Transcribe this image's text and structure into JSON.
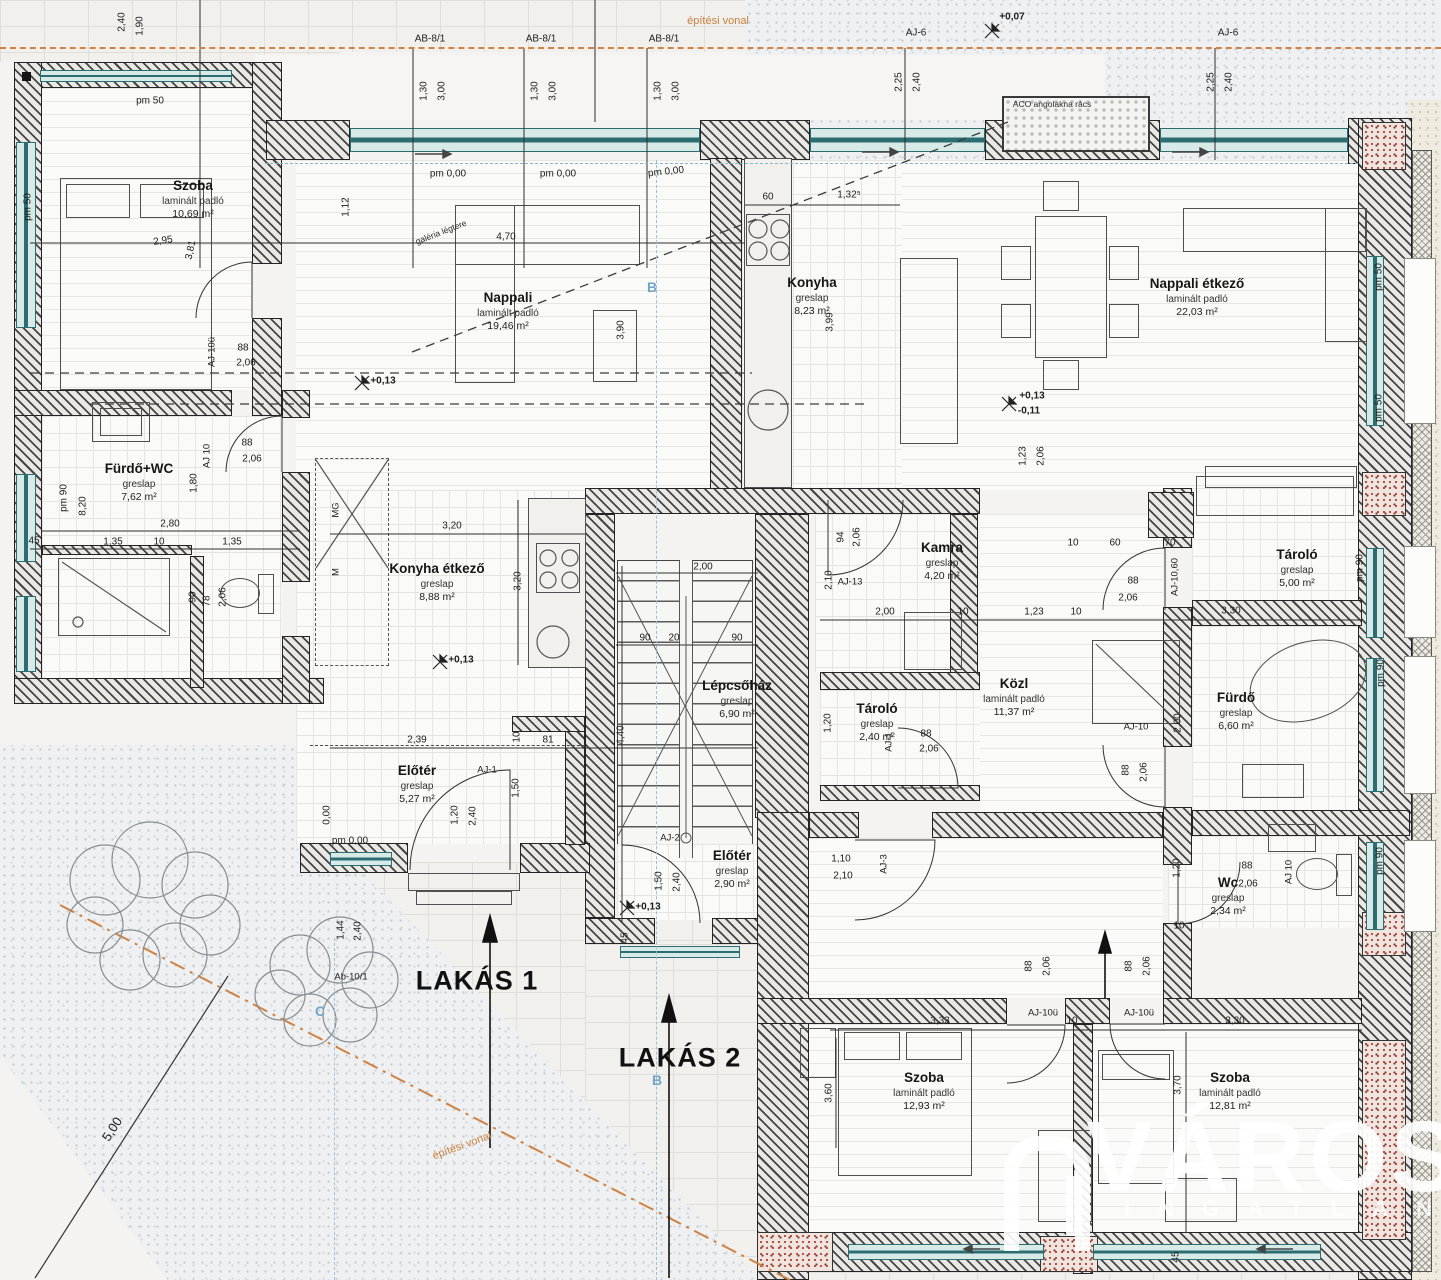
{
  "title": "társasházi alaprajz",
  "apartments": [
    {
      "label": "LAKÁS 1",
      "x": 477,
      "y": 981
    },
    {
      "label": "LAKÁS 2",
      "x": 680,
      "y": 1058
    }
  ],
  "watermark": {
    "title": "VÁROSI",
    "subtitle": "INGATLAN"
  },
  "colors": {
    "build_line": "#cf8243",
    "window": "#2c6d72",
    "section": "#70a5c9",
    "wall": "#242424"
  },
  "rooms": [
    {
      "name": "Szoba",
      "mat": "laminált padló",
      "area": "10,69 m²",
      "x": 193,
      "y": 187
    },
    {
      "name": "Nappali",
      "mat": "laminált padló",
      "area": "19,46 m²",
      "x": 508,
      "y": 299
    },
    {
      "name": "Konyha",
      "mat": "greslap",
      "area": "8,23 m²",
      "x": 812,
      "y": 284
    },
    {
      "name": "Nappali étkező",
      "mat": "laminált padló",
      "area": "22,03 m²",
      "x": 1197,
      "y": 285
    },
    {
      "name": "Fürdő+WC",
      "mat": "greslap",
      "area": "7,62 m²",
      "x": 139,
      "y": 470
    },
    {
      "name": "Konyha étkező",
      "mat": "greslap",
      "area": "8,88 m²",
      "x": 437,
      "y": 570
    },
    {
      "name": "Lépcsőház",
      "mat": "greslap",
      "area": "6,90 m²",
      "x": 737,
      "y": 687
    },
    {
      "name": "Előtér",
      "mat": "greslap",
      "area": "5,27 m²",
      "x": 417,
      "y": 772
    },
    {
      "name": "Előtér",
      "mat": "greslap",
      "area": "2,90 m²",
      "x": 732,
      "y": 857
    },
    {
      "name": "Kamra",
      "mat": "greslap",
      "area": "4,20 m²",
      "x": 942,
      "y": 549
    },
    {
      "name": "Tároló",
      "mat": "greslap",
      "area": "2,40 m²",
      "x": 877,
      "y": 710
    },
    {
      "name": "Közl",
      "mat": "laminált padló",
      "area": "11,37 m²",
      "x": 1014,
      "y": 685
    },
    {
      "name": "Fürdő",
      "mat": "greslap",
      "area": "6,60 m²",
      "x": 1236,
      "y": 699
    },
    {
      "name": "Tároló",
      "mat": "greslap",
      "area": "5,00 m²",
      "x": 1297,
      "y": 556
    },
    {
      "name": "Wc",
      "mat": "greslap",
      "area": "2,34 m²",
      "x": 1228,
      "y": 884
    },
    {
      "name": "Szoba",
      "mat": "laminált padló",
      "area": "12,93 m²",
      "x": 924,
      "y": 1079
    },
    {
      "name": "Szoba",
      "mat": "laminált padló",
      "area": "12,81 m²",
      "x": 1230,
      "y": 1079
    }
  ],
  "labels": [
    {
      "t": "2,40",
      "x": 122,
      "y": 22,
      "r": -90
    },
    {
      "t": "1,90",
      "x": 140,
      "y": 26,
      "r": -90
    },
    {
      "t": "AB-8/1",
      "x": 430,
      "y": 39
    },
    {
      "t": "AB-8/1",
      "x": 541,
      "y": 39
    },
    {
      "t": "AB-8/1",
      "x": 664,
      "y": 39
    },
    {
      "t": "1,30",
      "x": 424,
      "y": 91,
      "r": -90
    },
    {
      "t": "3,00",
      "x": 442,
      "y": 91,
      "r": -90
    },
    {
      "t": "1,30",
      "x": 535,
      "y": 91,
      "r": -90
    },
    {
      "t": "3,00",
      "x": 553,
      "y": 91,
      "r": -90
    },
    {
      "t": "1,30",
      "x": 658,
      "y": 91,
      "r": -90
    },
    {
      "t": "3,00",
      "x": 676,
      "y": 91,
      "r": -90
    },
    {
      "t": "pm 0,00",
      "x": 448,
      "y": 174
    },
    {
      "t": "pm 0,00",
      "x": 558,
      "y": 174
    },
    {
      "t": "pm 0,00",
      "x": 666,
      "y": 172,
      "r": -6
    },
    {
      "t": "építési vonal",
      "x": 718,
      "y": 21,
      "c": "note"
    },
    {
      "t": "AJ-6",
      "x": 916,
      "y": 33
    },
    {
      "t": "2,25",
      "x": 899,
      "y": 82,
      "r": -90
    },
    {
      "t": "2,40",
      "x": 917,
      "y": 82,
      "r": -90
    },
    {
      "t": "AJ-6",
      "x": 1228,
      "y": 33
    },
    {
      "t": "2,25",
      "x": 1211,
      "y": 82,
      "r": -90
    },
    {
      "t": "2,40",
      "x": 1229,
      "y": 82,
      "r": -90
    },
    {
      "t": "+0,07",
      "x": 1012,
      "y": 17,
      "c": "level"
    },
    {
      "t": "ACO angolakna rács",
      "x": 1052,
      "y": 104,
      "c": "tiny"
    },
    {
      "t": "pm 50",
      "x": 150,
      "y": 101
    },
    {
      "t": "pm 50",
      "x": 28,
      "y": 207,
      "r": -90
    },
    {
      "t": "2,95",
      "x": 163,
      "y": 241,
      "r": -8
    },
    {
      "t": "3,81",
      "x": 191,
      "y": 250,
      "r": -78
    },
    {
      "t": "1,12",
      "x": 346,
      "y": 207,
      "r": -90
    },
    {
      "t": "AJ-10ü",
      "x": 212,
      "y": 352,
      "r": -90,
      "c": "code"
    },
    {
      "t": "88",
      "x": 243,
      "y": 348
    },
    {
      "t": "2,06",
      "x": 246,
      "y": 363
    },
    {
      "t": "4,70",
      "x": 506,
      "y": 237
    },
    {
      "t": "3,90",
      "x": 621,
      "y": 330,
      "r": -90
    },
    {
      "t": "+0,13",
      "x": 383,
      "y": 381,
      "c": "level"
    },
    {
      "t": "galéria légtere",
      "x": 441,
      "y": 232,
      "r": -21,
      "c": "tiny"
    },
    {
      "t": "60",
      "x": 768,
      "y": 197
    },
    {
      "t": "1,32⁵",
      "x": 849,
      "y": 195
    },
    {
      "t": "3,99",
      "x": 830,
      "y": 322,
      "r": -90
    },
    {
      "t": "+0,13",
      "x": 1032,
      "y": 396,
      "c": "level"
    },
    {
      "t": "-0,11",
      "x": 1029,
      "y": 411,
      "c": "level"
    },
    {
      "t": "1,23",
      "x": 1023,
      "y": 456,
      "r": -90
    },
    {
      "t": "2,06",
      "x": 1041,
      "y": 456,
      "r": -90
    },
    {
      "t": "pm 50",
      "x": 1379,
      "y": 277,
      "r": -90
    },
    {
      "t": "pm 50",
      "x": 1379,
      "y": 408,
      "r": -90
    },
    {
      "t": "2,80",
      "x": 170,
      "y": 524
    },
    {
      "t": "1,35",
      "x": 113,
      "y": 542
    },
    {
      "t": "10",
      "x": 159,
      "y": 542
    },
    {
      "t": "1,35",
      "x": 232,
      "y": 542
    },
    {
      "t": "1,80",
      "x": 194,
      "y": 483,
      "r": -90
    },
    {
      "t": "AJ 10",
      "x": 207,
      "y": 456,
      "r": -90,
      "c": "code"
    },
    {
      "t": "88",
      "x": 247,
      "y": 443
    },
    {
      "t": "2,06",
      "x": 252,
      "y": 459
    },
    {
      "t": "pm 90",
      "x": 64,
      "y": 498,
      "r": -90
    },
    {
      "t": "8,20",
      "x": 83,
      "y": 506,
      "r": -90
    },
    {
      "t": "45",
      "x": 34,
      "y": 541
    },
    {
      "t": "90",
      "x": 193,
      "y": 597,
      "r": -90
    },
    {
      "t": "78",
      "x": 207,
      "y": 601,
      "r": -90
    },
    {
      "t": "2,06",
      "x": 223,
      "y": 597,
      "r": -90
    },
    {
      "t": "MG",
      "x": 336,
      "y": 510,
      "r": -90,
      "c": "code"
    },
    {
      "t": "M",
      "x": 336,
      "y": 572,
      "r": -90,
      "c": "code"
    },
    {
      "t": "3,20",
      "x": 452,
      "y": 526
    },
    {
      "t": "3,20",
      "x": 518,
      "y": 581,
      "r": -90
    },
    {
      "t": "+0,13",
      "x": 461,
      "y": 660,
      "c": "level"
    },
    {
      "t": "2,39",
      "x": 417,
      "y": 740
    },
    {
      "t": "10",
      "x": 517,
      "y": 737,
      "r": -90
    },
    {
      "t": "81",
      "x": 548,
      "y": 740
    },
    {
      "t": "2,00",
      "x": 703,
      "y": 567
    },
    {
      "t": "90",
      "x": 645,
      "y": 638
    },
    {
      "t": "20",
      "x": 674,
      "y": 638
    },
    {
      "t": "90",
      "x": 737,
      "y": 638
    },
    {
      "t": "4,40",
      "x": 621,
      "y": 735,
      "r": -90
    },
    {
      "t": "AJ-2",
      "x": 670,
      "y": 838,
      "c": "code"
    },
    {
      "t": "1,50",
      "x": 659,
      "y": 881,
      "r": -90
    },
    {
      "t": "2,40",
      "x": 677,
      "y": 882,
      "r": -90
    },
    {
      "t": "AJ-1",
      "x": 487,
      "y": 770,
      "c": "code"
    },
    {
      "t": "1,20",
      "x": 455,
      "y": 815,
      "r": -90
    },
    {
      "t": "2,40",
      "x": 473,
      "y": 816,
      "r": -90
    },
    {
      "t": "1,50",
      "x": 516,
      "y": 788,
      "r": -90
    },
    {
      "t": "pm 0,00",
      "x": 350,
      "y": 841
    },
    {
      "t": "0,00",
      "x": 327,
      "y": 815,
      "r": -90
    },
    {
      "t": "1,44",
      "x": 341,
      "y": 930,
      "r": -90
    },
    {
      "t": "2,40",
      "x": 358,
      "y": 931,
      "r": -90
    },
    {
      "t": "Ab-10/1",
      "x": 351,
      "y": 977,
      "c": "code"
    },
    {
      "t": "+0,13",
      "x": 648,
      "y": 907,
      "c": "level"
    },
    {
      "t": "45",
      "x": 625,
      "y": 938,
      "r": -90
    },
    {
      "t": "AJ-3",
      "x": 884,
      "y": 864,
      "r": -90,
      "c": "code"
    },
    {
      "t": "1,10",
      "x": 841,
      "y": 859
    },
    {
      "t": "2,10",
      "x": 843,
      "y": 876
    },
    {
      "t": "AJ-13",
      "x": 850,
      "y": 582,
      "c": "code"
    },
    {
      "t": "2,10",
      "x": 829,
      "y": 580,
      "r": -90
    },
    {
      "t": "94",
      "x": 841,
      "y": 537,
      "r": -90
    },
    {
      "t": "2,06",
      "x": 857,
      "y": 537,
      "r": -90
    },
    {
      "t": "2,00",
      "x": 885,
      "y": 612
    },
    {
      "t": "10",
      "x": 963,
      "y": 612
    },
    {
      "t": "1,23",
      "x": 1034,
      "y": 612
    },
    {
      "t": "10",
      "x": 1076,
      "y": 612
    },
    {
      "t": "10",
      "x": 1073,
      "y": 543
    },
    {
      "t": "60",
      "x": 1115,
      "y": 543
    },
    {
      "t": "70",
      "x": 1170,
      "y": 543
    },
    {
      "t": "88",
      "x": 1133,
      "y": 581
    },
    {
      "t": "2,06",
      "x": 1128,
      "y": 598
    },
    {
      "t": "AJ-10,60",
      "x": 1175,
      "y": 577,
      "r": -90,
      "c": "code"
    },
    {
      "t": "1,20",
      "x": 828,
      "y": 723,
      "r": -90
    },
    {
      "t": "AJ-1",
      "x": 889,
      "y": 742,
      "r": -90,
      "c": "code"
    },
    {
      "t": "88",
      "x": 926,
      "y": 734
    },
    {
      "t": "2,06",
      "x": 929,
      "y": 749
    },
    {
      "t": "AJ-10",
      "x": 1136,
      "y": 727,
      "c": "code"
    },
    {
      "t": "2,00",
      "x": 1178,
      "y": 723,
      "r": -90
    },
    {
      "t": "pm 90",
      "x": 1360,
      "y": 568,
      "r": -90
    },
    {
      "t": "pm 90",
      "x": 1381,
      "y": 673,
      "r": -90
    },
    {
      "t": "3,30",
      "x": 1231,
      "y": 611
    },
    {
      "t": "88",
      "x": 1126,
      "y": 770,
      "r": -90
    },
    {
      "t": "2,06",
      "x": 1144,
      "y": 772,
      "r": -90
    },
    {
      "t": "88",
      "x": 1029,
      "y": 966,
      "r": -90
    },
    {
      "t": "2,06",
      "x": 1047,
      "y": 966,
      "r": -90
    },
    {
      "t": "88",
      "x": 1129,
      "y": 966,
      "r": -90
    },
    {
      "t": "2,06",
      "x": 1147,
      "y": 966,
      "r": -90
    },
    {
      "t": "88",
      "x": 1247,
      "y": 866
    },
    {
      "t": "2,06",
      "x": 1248,
      "y": 884
    },
    {
      "t": "AJ 10",
      "x": 1289,
      "y": 872,
      "r": -90,
      "c": "code"
    },
    {
      "t": "1,20",
      "x": 1177,
      "y": 868,
      "r": -90
    },
    {
      "t": "pm 90",
      "x": 1380,
      "y": 861,
      "r": -90
    },
    {
      "t": "10",
      "x": 1179,
      "y": 926
    },
    {
      "t": "AJ-10ü",
      "x": 1043,
      "y": 1013,
      "c": "code"
    },
    {
      "t": "10",
      "x": 1072,
      "y": 1021
    },
    {
      "t": "AJ-10ü",
      "x": 1139,
      "y": 1013,
      "c": "code"
    },
    {
      "t": "3,33",
      "x": 940,
      "y": 1021
    },
    {
      "t": "3,30",
      "x": 1235,
      "y": 1021
    },
    {
      "t": "3,70",
      "x": 1178,
      "y": 1085,
      "r": -90
    },
    {
      "t": "3,60",
      "x": 829,
      "y": 1093,
      "r": -90
    },
    {
      "t": "45",
      "x": 1176,
      "y": 1257,
      "r": -90
    },
    {
      "t": "5,00",
      "x": 112,
      "y": 1129,
      "r": -57,
      "c": "dimlg"
    },
    {
      "t": "építési vonal",
      "x": 462,
      "y": 1146,
      "r": -20,
      "c": "note"
    },
    {
      "t": "B",
      "x": 652,
      "y": 287,
      "c": "section"
    },
    {
      "t": "B",
      "x": 657,
      "y": 1080,
      "c": "section"
    },
    {
      "t": "C",
      "x": 320,
      "y": 1011,
      "c": "section"
    }
  ]
}
